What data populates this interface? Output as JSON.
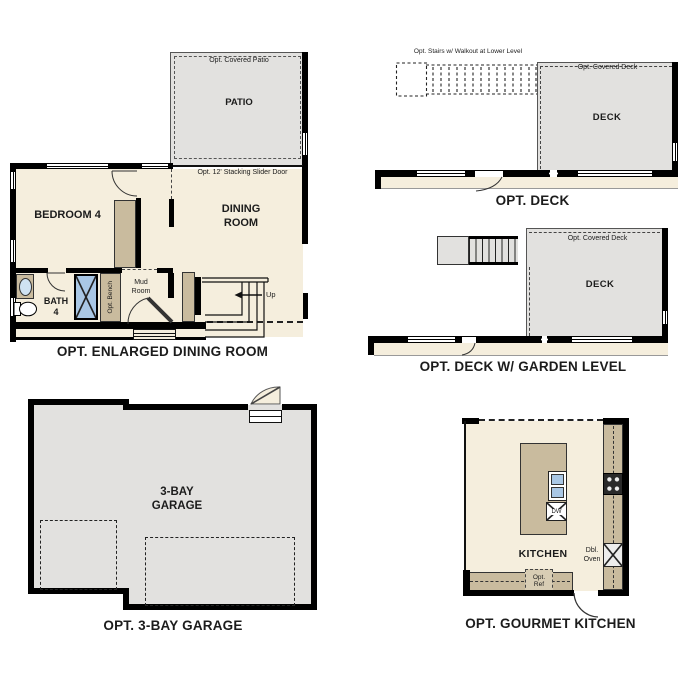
{
  "colors": {
    "wall": "#000000",
    "interior": "#f5eedd",
    "concrete_gray": "#e2e1df",
    "cabinet_tan": "#c9bb9e",
    "fixture_blue": "#a9c7e5",
    "text": "#1c1c1c"
  },
  "plans": {
    "enlarged_dining": {
      "caption": "OPT. ENLARGED DINING ROOM",
      "covered_patio_label": "Opt. Covered Patio",
      "patio_label": "PATIO",
      "slider_label": "Opt. 12' Stacking Slider Door",
      "bedroom_label": "BEDROOM 4",
      "dining_label": "DINING\nROOM",
      "bath_label": "BATH\n4",
      "bench_label": "Opt. Bench",
      "mud_label": "Mud\nRoom",
      "up_label": "Up"
    },
    "deck": {
      "caption": "OPT. DECK",
      "stairs_note": "Opt. Stairs w/ Walkout at Lower Level",
      "covered_deck_label": "Opt. Covered Deck",
      "deck_label": "DECK"
    },
    "deck_garden": {
      "caption": "OPT. DECK W/ GARDEN LEVEL",
      "covered_deck_label": "Opt. Covered Deck",
      "deck_label": "DECK"
    },
    "garage": {
      "caption": "OPT. 3-BAY GARAGE",
      "room_label": "3-BAY\nGARAGE"
    },
    "kitchen": {
      "caption": "OPT. GOURMET KITCHEN",
      "room_label": "KITCHEN",
      "dw_label": "DW",
      "oven_label": "Dbl.\nOven",
      "ref_label": "Opt.\nRef"
    }
  }
}
